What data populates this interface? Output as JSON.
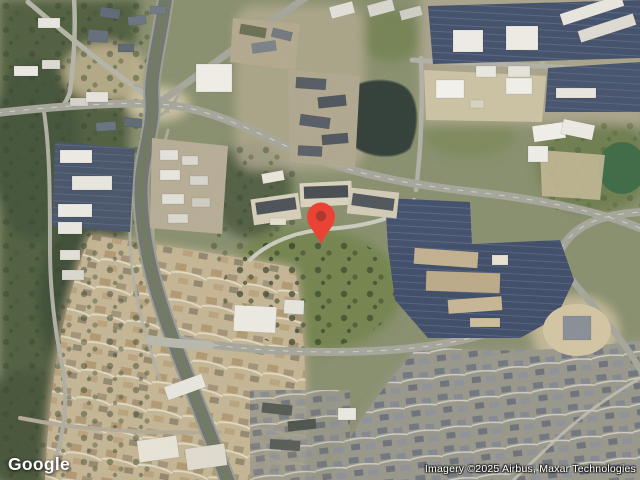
{
  "footer": {
    "logo_text": "Google",
    "attribution": "Imagery ©2025 Airbus, Maxar Technologies"
  },
  "map": {
    "kind": "satellite-imagery",
    "marker": {
      "color": "#EA4335",
      "inner_color": "#A93A2D",
      "x": 321,
      "y": 244
    }
  },
  "palette": {
    "vegetation_dark": "#4a5a3c",
    "vegetation_light": "#75854f",
    "residential_tan": "#c2b394",
    "road_gray": "#a6a69b",
    "freeway_gray": "#72766d",
    "parking_dark": "#43506a",
    "building_white": "#efede5",
    "pond_dark": "#333f38",
    "pond_green": "#3f6b45"
  }
}
